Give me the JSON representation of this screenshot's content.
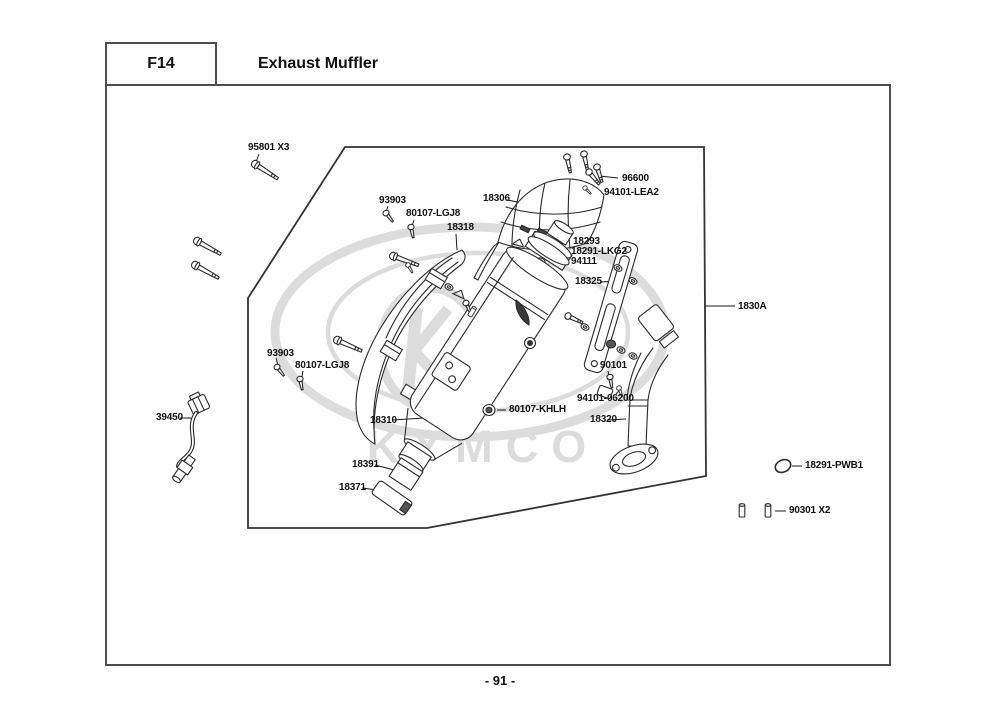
{
  "header": {
    "section_code": "F14",
    "title": "Exhaust Muffler"
  },
  "footer": {
    "page_number": "- 91 -"
  },
  "watermark": {
    "brand": "KYMCO"
  },
  "colors": {
    "line_art": "#2a2a2a",
    "frame": "#333333",
    "page_border": "#4d4d4d",
    "watermark": "#dcdcdc",
    "label_text": "#111111"
  },
  "diagram": {
    "part_labels": [
      {
        "label": "95801 X3"
      },
      {
        "label": "93903"
      },
      {
        "label": "80107-LGJ8"
      },
      {
        "label": "18318"
      },
      {
        "label": "18306"
      },
      {
        "label": "96600"
      },
      {
        "label": "94101-LEA2"
      },
      {
        "label": "18293"
      },
      {
        "label": "18291-LKG2"
      },
      {
        "label": "94111"
      },
      {
        "label": "18325"
      },
      {
        "label": "1830A"
      },
      {
        "label": "90101"
      },
      {
        "label": "94101-06200"
      },
      {
        "label": "18320"
      },
      {
        "label": "93903"
      },
      {
        "label": "80107-LGJ8"
      },
      {
        "label": "39450"
      },
      {
        "label": "18310"
      },
      {
        "label": "80107-KHLH"
      },
      {
        "label": "18391"
      },
      {
        "label": "18371"
      },
      {
        "label": "18291-PWB1"
      },
      {
        "label": "90301 X2"
      }
    ]
  }
}
